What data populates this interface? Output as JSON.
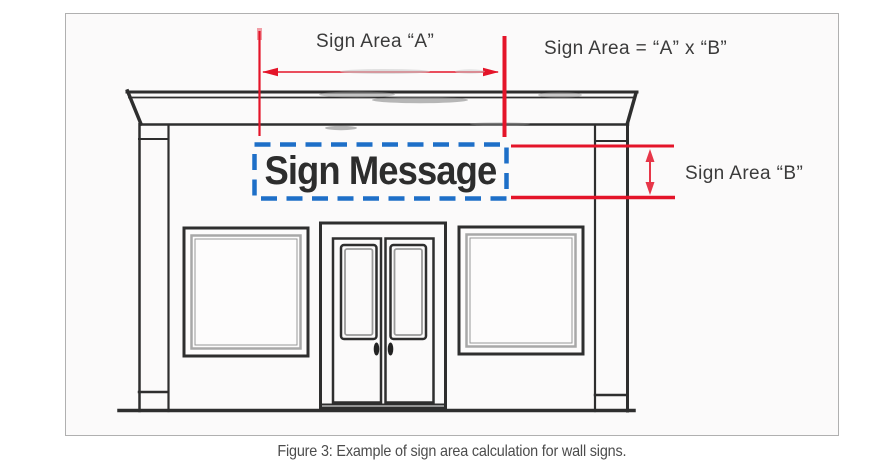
{
  "figure": {
    "caption": "Figure 3: Example of sign area calculation for wall signs.",
    "annotations": {
      "width_label": "Sign Area “A”",
      "formula_label": "Sign Area = “A” x “B”",
      "height_label": "Sign Area “B”",
      "sign_text": "Sign Message"
    },
    "colors": {
      "annotation_red": "#e41429",
      "sign_outline_blue": "#1e6fc8",
      "drawing_ink": "#2e2e2e",
      "caption_text": "#4c4c4c",
      "frame_border": "#b0b0b0"
    }
  }
}
